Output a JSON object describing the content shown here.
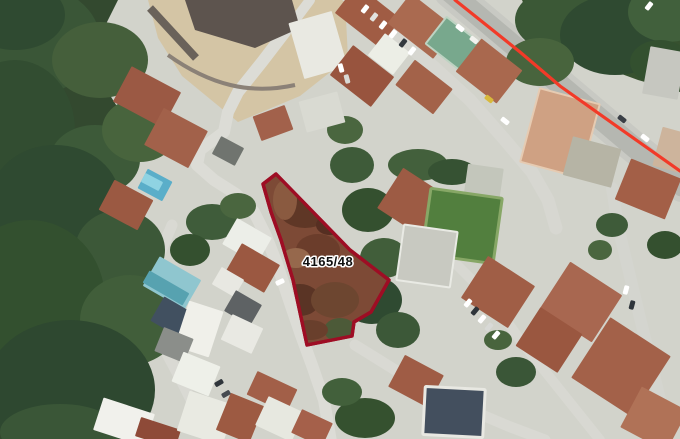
{
  "map": {
    "kind": "satellite-cadastral-view",
    "parcel": {
      "label": "4165/48",
      "outline_color": "#9e0d24",
      "fill_color": "#7d4a36",
      "label_color": "#101010",
      "label_halo": "#ffffff",
      "points": "276,174 263,184 271,212 281,240 293,280 307,345 352,336 354,322 371,312 389,280 350,250",
      "label_x": "328",
      "label_y": "266"
    },
    "road_overlay": {
      "color": "#f23a28",
      "width": "3.2",
      "points": "455,0 520,52 560,86 622,130 680,171"
    },
    "ground_color": "#d2d3cb"
  }
}
